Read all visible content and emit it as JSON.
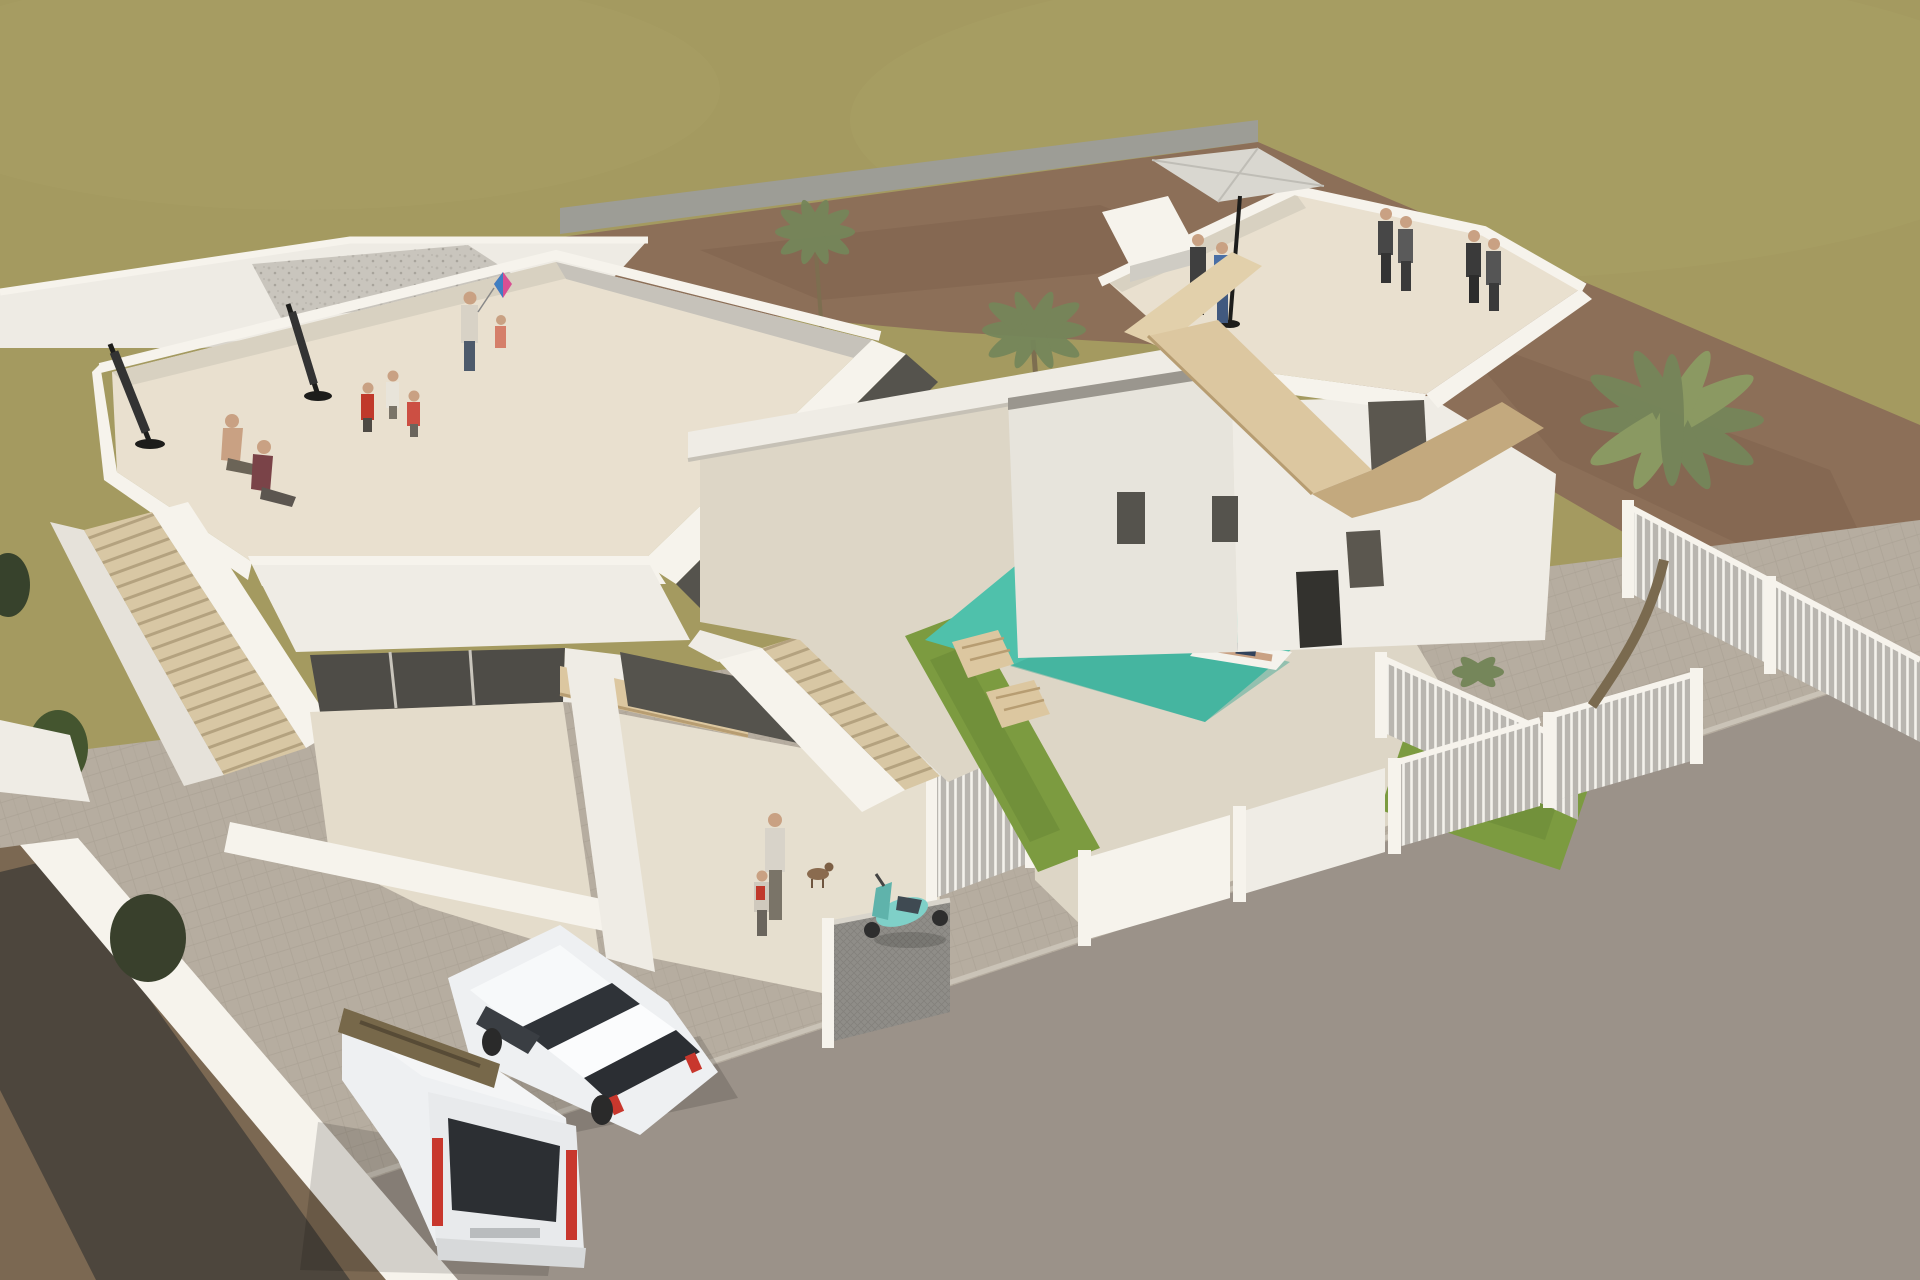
{
  "meta": {
    "title": "Aerial 3D architectural render – two modern white villas with pool",
    "type": "3d-architectural-visualization",
    "description": "High-angle render of a new-build residential corner plot: two white flat-roofed villas with cream roof terraces, exterior wooden stairs and balconies, a turquoise pool garden with lawns and sun loungers, white slatted fences, a paved sidewalk and asphalt street, parked white hatchback and van, a teal scooter, palm trees, an olive-green backdrop field and red-brown dirt plots."
  },
  "colors": {
    "field": "#a49a60",
    "field_light": "#aca268",
    "road": "#9d9d96",
    "dirt": "#8c6f58",
    "dirt_dark": "#6e523e",
    "ground_dirt": "#7b6852",
    "shadow_dark": "#45413a",
    "paver": "#b6ada0",
    "asphalt": "#9b9289",
    "curb": "#cac3b7",
    "white_bright": "#f6f3ec",
    "white_lit": "#efece5",
    "white_top": "#eeebe4",
    "white_shade": "#dedad2",
    "white_deep": "#c6c2ba",
    "terrace": "#e9e0cf",
    "terrace_shade": "#d8d1c1",
    "glass": "#55534d",
    "glass_dark": "#33322e",
    "wood": "#dcc7a0",
    "wood_shade": "#c3a97e",
    "wood_dark": "#77684a",
    "steps": "#d8c7a4",
    "pool": "#4fc1ab",
    "pool_light": "#83d8c7",
    "pool_deep": "#3aa693",
    "grass": "#7c9b40",
    "grass_dark": "#5e7a31",
    "palm": "#75865a",
    "palm_light": "#8b9c63",
    "fence_gray": "#b9b6b0",
    "skin": "#c9a183",
    "maroon": "#7a4348",
    "red": "#c0392b",
    "scooter": "#7fd0c8",
    "denim": "#4a6fa5",
    "navy": "#31425c",
    "car_white": "#eef0f2",
    "tail_red": "#c8372d",
    "parasol_gray": "#d9d7d0",
    "dark": "#1d1d1b"
  },
  "scene": {
    "background": {
      "field_label": "olive-green open field backdrop",
      "back_road_label": "gray road behind the plots",
      "dirt_field_label": "red-brown unbuilt dirt plots",
      "palm_count": 4
    },
    "left_villa": {
      "label": "left white villa with roof terrace",
      "roof_terrace_people": [
        "seated shirtless man",
        "seated woman in maroon top",
        "child in red",
        "child in white",
        "child in pink",
        "woman flying pink-blue kite",
        "toddler beside kite"
      ],
      "closed_parasols": 2,
      "gravel_roof_label": "gravel flat roof at rear",
      "balcony_label": "plywood-clad balcony with standing visitor",
      "side_stairs_label": "external staircase to terrace"
    },
    "courtyard": {
      "label": "walled front courtyard",
      "figures": [
        "adult walking",
        "child with red backpack",
        "small dog"
      ],
      "scooter_label": "teal scooter parked at fence",
      "stairs_label": "central exterior staircase"
    },
    "pool_garden": {
      "label": "shared pool garden",
      "pool_label": "turquoise rectangular pool",
      "swimmers": 2,
      "float_label": "person sunbathing on white pool float",
      "loungers_left": 2,
      "lawn_label": "green lawn strips"
    },
    "right_villa": {
      "label": "right white villa with angled roof terrace",
      "roof_people_pairs": 3,
      "open_parasol": 1,
      "wood_stairs_label": "zigzag timber staircase on facade"
    },
    "right_garden": {
      "label": "fenced right garden",
      "loungers": 3,
      "people": [
        "person sitting on lounger",
        "person lying on lounger"
      ],
      "big_palm_label": "tall palm tree"
    },
    "street": {
      "sidewalk_label": "light paver sidewalk",
      "asphalt_label": "asphalt street",
      "fence_panels": 6
    },
    "foreground": {
      "dirt_label": "brown dirt verge with long shadow",
      "vehicles": [
        "white hatchback, nose-in parked",
        "white van with red tail lights"
      ],
      "carport_beam_label": "weathered timber carport beam"
    }
  }
}
